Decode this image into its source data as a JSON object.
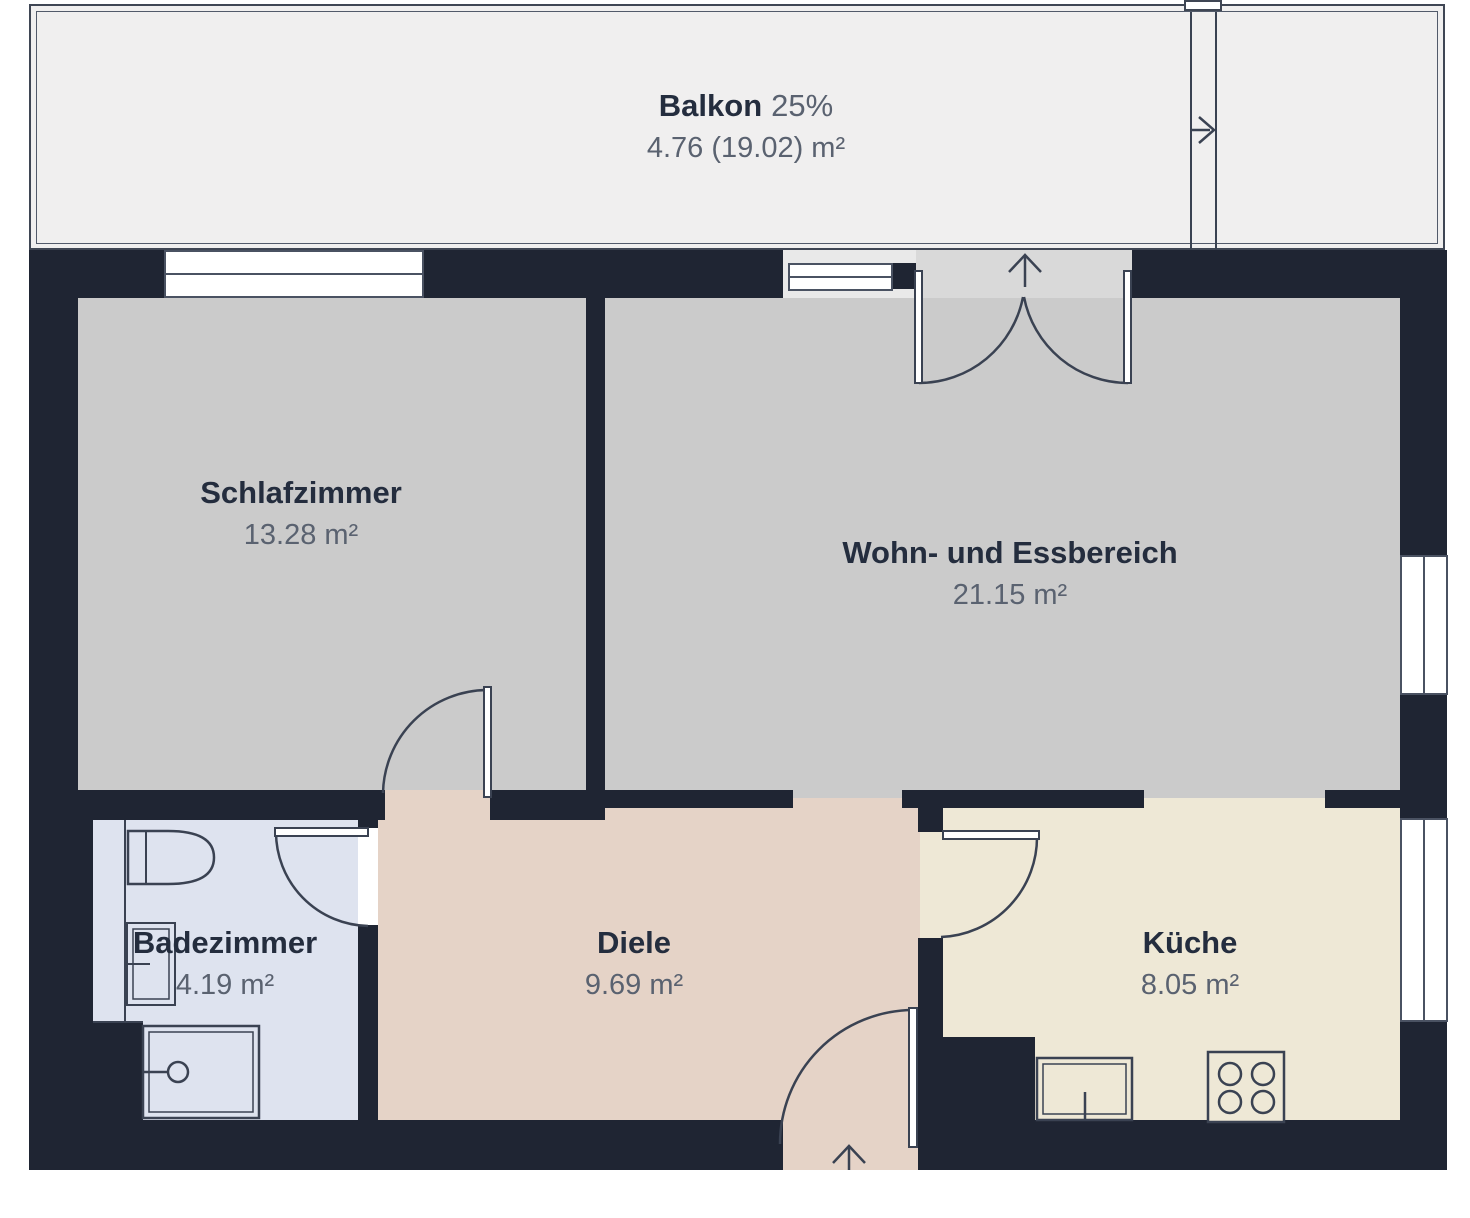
{
  "plan_title": "Wohnungsgrundriss",
  "rooms": [
    {
      "id": "balkon",
      "name": "Balkon",
      "share": "25%",
      "area": "4.76 (19.02) m²"
    },
    {
      "id": "schlafzimmer",
      "name": "Schlafzimmer",
      "area": "13.28 m²"
    },
    {
      "id": "wohn-essbereich",
      "name": "Wohn- und Essbereich",
      "area": "21.15 m²"
    },
    {
      "id": "badezimmer",
      "name": "Badezimmer",
      "area": "4.19 m²"
    },
    {
      "id": "diele",
      "name": "Diele",
      "area": "9.69 m²"
    },
    {
      "id": "kueche",
      "name": "Küche",
      "area": "8.05 m²"
    }
  ],
  "fixtures": [
    "toilet",
    "bathroom-sink",
    "shower",
    "kitchen-sink",
    "stove"
  ],
  "doors": [
    "balcony-french-door",
    "bedroom-door",
    "bathroom-door",
    "kitchen-door",
    "apartment-entrance-door"
  ],
  "arrows": [
    "balcony-door-swing-arrow",
    "entrance-arrow",
    "balcony-divider-arrow"
  ],
  "colors": {
    "wall": "#1f2533",
    "line": "#3a4252",
    "balcony_fill": "#f0efef",
    "living_fill": "#cbcbcb",
    "bathroom_fill": "#dee3ef",
    "hallway_fill": "#e5d3c7",
    "kitchen_fill": "#eee8d6",
    "threshold_fill": "#d9d9d9",
    "room_name_text": "#242d3e",
    "room_area_text": "#5a6270"
  }
}
